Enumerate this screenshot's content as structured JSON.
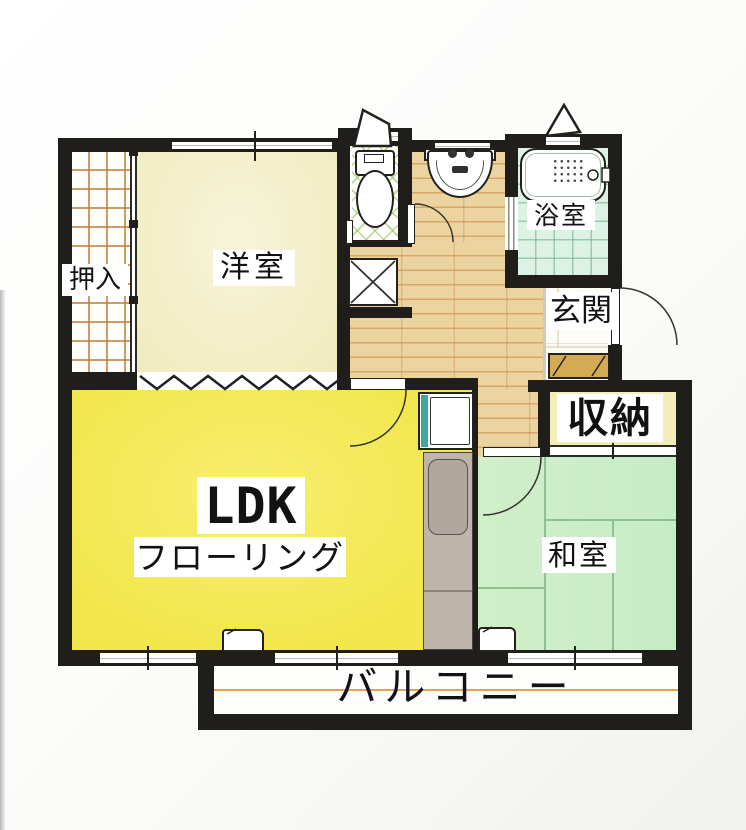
{
  "plan": {
    "type": "apartment-floor-plan",
    "rooms": {
      "oshiire": {
        "label": "押入"
      },
      "yoshitsu": {
        "label": "洋室"
      },
      "bath": {
        "label": "浴室"
      },
      "genkan": {
        "label": "玄関"
      },
      "shunou": {
        "label": "収納"
      },
      "ldk": {
        "label": "LDK",
        "sublabel": "フローリング"
      },
      "washitsu": {
        "label": "和室"
      },
      "balcony": {
        "label": "バルコニー"
      }
    },
    "fixtures": [
      "toilet",
      "washbasin",
      "bathtub",
      "kitchen-sink",
      "kitchen-counter",
      "shoe-cabinet",
      "pipe-space",
      "air-conditioner",
      "air-conditioner"
    ]
  },
  "colors": {
    "wall": "#1f1e1b",
    "ldk": "#f1e64b",
    "shunou": "#f3edb7",
    "washitsu": "#c6ecc6",
    "bath": "#ddf2e4",
    "wood": "#ecd4a0",
    "teal": "#3fa79c",
    "counter": "#beb5ab",
    "cabinet": "#d4ab52",
    "orange": "#e8a24a",
    "tatami": "#8fc08f"
  }
}
